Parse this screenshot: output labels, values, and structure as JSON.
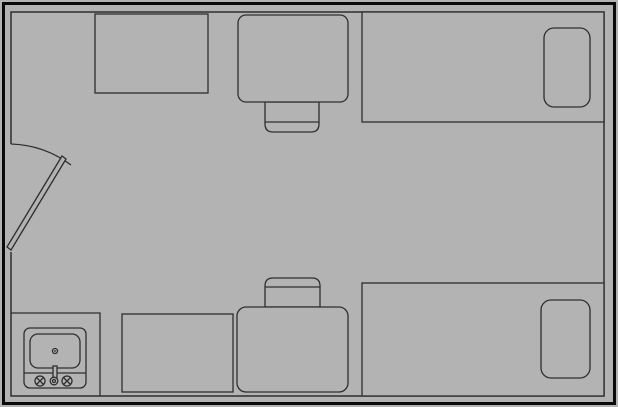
{
  "palette": {
    "background": "#b3b3b3",
    "line": "#2e2e2e",
    "outer_wall": "#0a0a0a"
  },
  "canvas": {
    "width": 618,
    "height": 407
  },
  "walls": {
    "outer": {
      "x": 3.5,
      "y": 3.5,
      "w": 611,
      "h": 400
    },
    "inner": {
      "d": "M 11 252 L 11 396 L 604 396 L 604 12 L 11 12 L 11 144"
    }
  },
  "door": {
    "swing_arc": {
      "d": "M 11 144 A 106 106 0 0 1 71 165"
    },
    "leaf": {
      "points": "7,247 62,156 66,159 11,250"
    }
  },
  "shapes": {
    "dresser_top": {
      "x": 95,
      "y": 14,
      "w": 113,
      "h": 79
    },
    "desk_top": {
      "x": 238,
      "y": 15,
      "w": 110,
      "h": 87,
      "r": 8
    },
    "chair_top_outline": {
      "d": "M 265 102 L 265 124 Q 265 132 273 132 L 311 132 Q 319 132 319 124 L 319 102 Z"
    },
    "chair_top_divider": {
      "d": "M 265 122 L 319 122"
    },
    "bed_top": {
      "x": 362,
      "y": 12,
      "w": 242,
      "h": 110
    },
    "pillow_top": {
      "x": 544,
      "y": 28,
      "w": 46,
      "h": 79,
      "r": 10
    },
    "bed_bottom": {
      "x": 362,
      "y": 283,
      "w": 242,
      "h": 113
    },
    "pillow_bottom": {
      "x": 541,
      "y": 300,
      "w": 49,
      "h": 78,
      "r": 10
    },
    "chair_bottom_outline": {
      "d": "M 265 307 L 265 286 Q 265 278 273 278 L 312 278 Q 320 278 320 286 L 320 307 Z"
    },
    "chair_bottom_divider": {
      "d": "M 265 287 L 320 287"
    },
    "desk_bottom": {
      "x": 237,
      "y": 307,
      "w": 111,
      "h": 85,
      "r": 9
    },
    "dresser_bottom": {
      "x": 122,
      "y": 314,
      "w": 111,
      "h": 78
    },
    "counter_edge": {
      "d": "M 11 313 L 100 313 L 100 396"
    },
    "sink_outer": {
      "x": 24,
      "y": 328,
      "w": 62,
      "h": 60,
      "r": 6
    },
    "sink_divider": {
      "d": "M 24 373 L 86 373"
    },
    "sink_basin": {
      "x": 30,
      "y": 334,
      "w": 50,
      "h": 34,
      "r": 8
    },
    "sink_drain": {
      "cx": 55,
      "cy": 351,
      "r": 2.5
    },
    "sink_drain_dot": {
      "cx": 55,
      "cy": 351,
      "r": 0.9
    },
    "faucet_pipe": {
      "x": 53,
      "y": 366,
      "w": 4,
      "h": 12
    },
    "faucet_handle_left": {
      "cx": 40,
      "cy": 381,
      "r": 5
    },
    "faucet_handle_left_cross": {
      "d": "M 36.5 377.5 L 43.5 384.5 M 43.5 377.5 L 36.5 384.5"
    },
    "faucet_spout": {
      "cx": 54,
      "cy": 381,
      "r": 3.8
    },
    "faucet_spout_inner": {
      "cx": 54,
      "cy": 381,
      "r": 1.5
    },
    "faucet_handle_right": {
      "cx": 67,
      "cy": 381,
      "r": 5
    },
    "faucet_handle_right_cross": {
      "d": "M 63.5 377.5 L 70.5 384.5 M 70.5 377.5 L 63.5 384.5"
    }
  }
}
